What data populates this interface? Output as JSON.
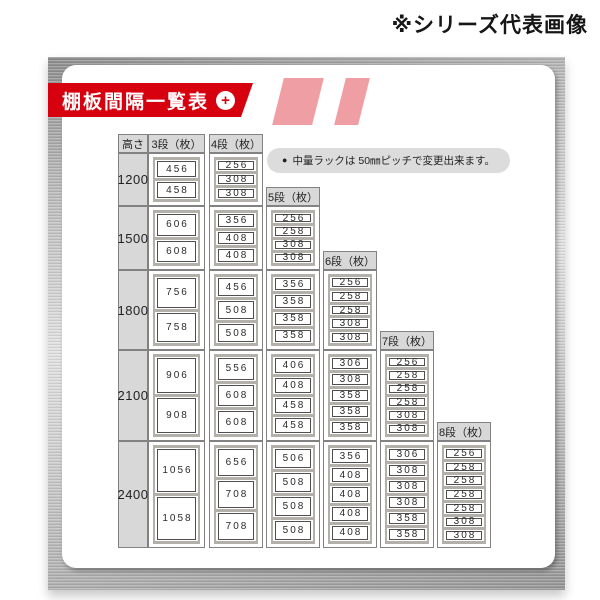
{
  "watermark": "※シリーズ代表画像",
  "banner": {
    "title": "棚板間隔一覧表",
    "plus": "+"
  },
  "note": {
    "bullet": "●",
    "text": "中量ラックは 50㎜ピッチで変更出来ます。"
  },
  "colors": {
    "banner_red": "#d7000f",
    "metal_gray": "#a9a9a9",
    "header_bg": "#d8d8d8",
    "cell_border": "#828282",
    "shelf_frame": "#b3b0aa"
  },
  "chart_data": {
    "type": "table",
    "title": "棚板間隔一覧表",
    "note": "中量ラックは 50㎜ピッチで変更出来ます。",
    "corner_header": "高さ",
    "tier_headers": [
      "3段（枚）",
      "4段（枚）",
      "5段（枚）",
      "6段（枚）",
      "7段（枚）",
      "8段（枚）"
    ],
    "rows": [
      {
        "height": "1200",
        "tiers": [
          [
            "456",
            "458"
          ],
          [
            "256",
            "308",
            "308"
          ],
          null,
          null,
          null,
          null
        ]
      },
      {
        "height": "1500",
        "tiers": [
          [
            "606",
            "608"
          ],
          [
            "356",
            "408",
            "408"
          ],
          [
            "256",
            "258",
            "308",
            "308"
          ],
          null,
          null,
          null
        ]
      },
      {
        "height": "1800",
        "tiers": [
          [
            "756",
            "758"
          ],
          [
            "456",
            "508",
            "508"
          ],
          [
            "356",
            "358",
            "358",
            "358"
          ],
          [
            "256",
            "258",
            "258",
            "308",
            "308"
          ],
          null,
          null
        ]
      },
      {
        "height": "2100",
        "tiers": [
          [
            "906",
            "908"
          ],
          [
            "556",
            "608",
            "608"
          ],
          [
            "406",
            "408",
            "458",
            "458"
          ],
          [
            "306",
            "308",
            "358",
            "358",
            "358"
          ],
          [
            "256",
            "258",
            "258",
            "258",
            "308",
            "308"
          ],
          null
        ]
      },
      {
        "height": "2400",
        "tiers": [
          [
            "1056",
            "1058"
          ],
          [
            "656",
            "708",
            "708"
          ],
          [
            "506",
            "508",
            "508",
            "508"
          ],
          [
            "356",
            "408",
            "408",
            "408",
            "408"
          ],
          [
            "306",
            "308",
            "308",
            "308",
            "358",
            "358"
          ],
          [
            "256",
            "258",
            "258",
            "258",
            "258",
            "308",
            "308"
          ]
        ]
      }
    ]
  }
}
